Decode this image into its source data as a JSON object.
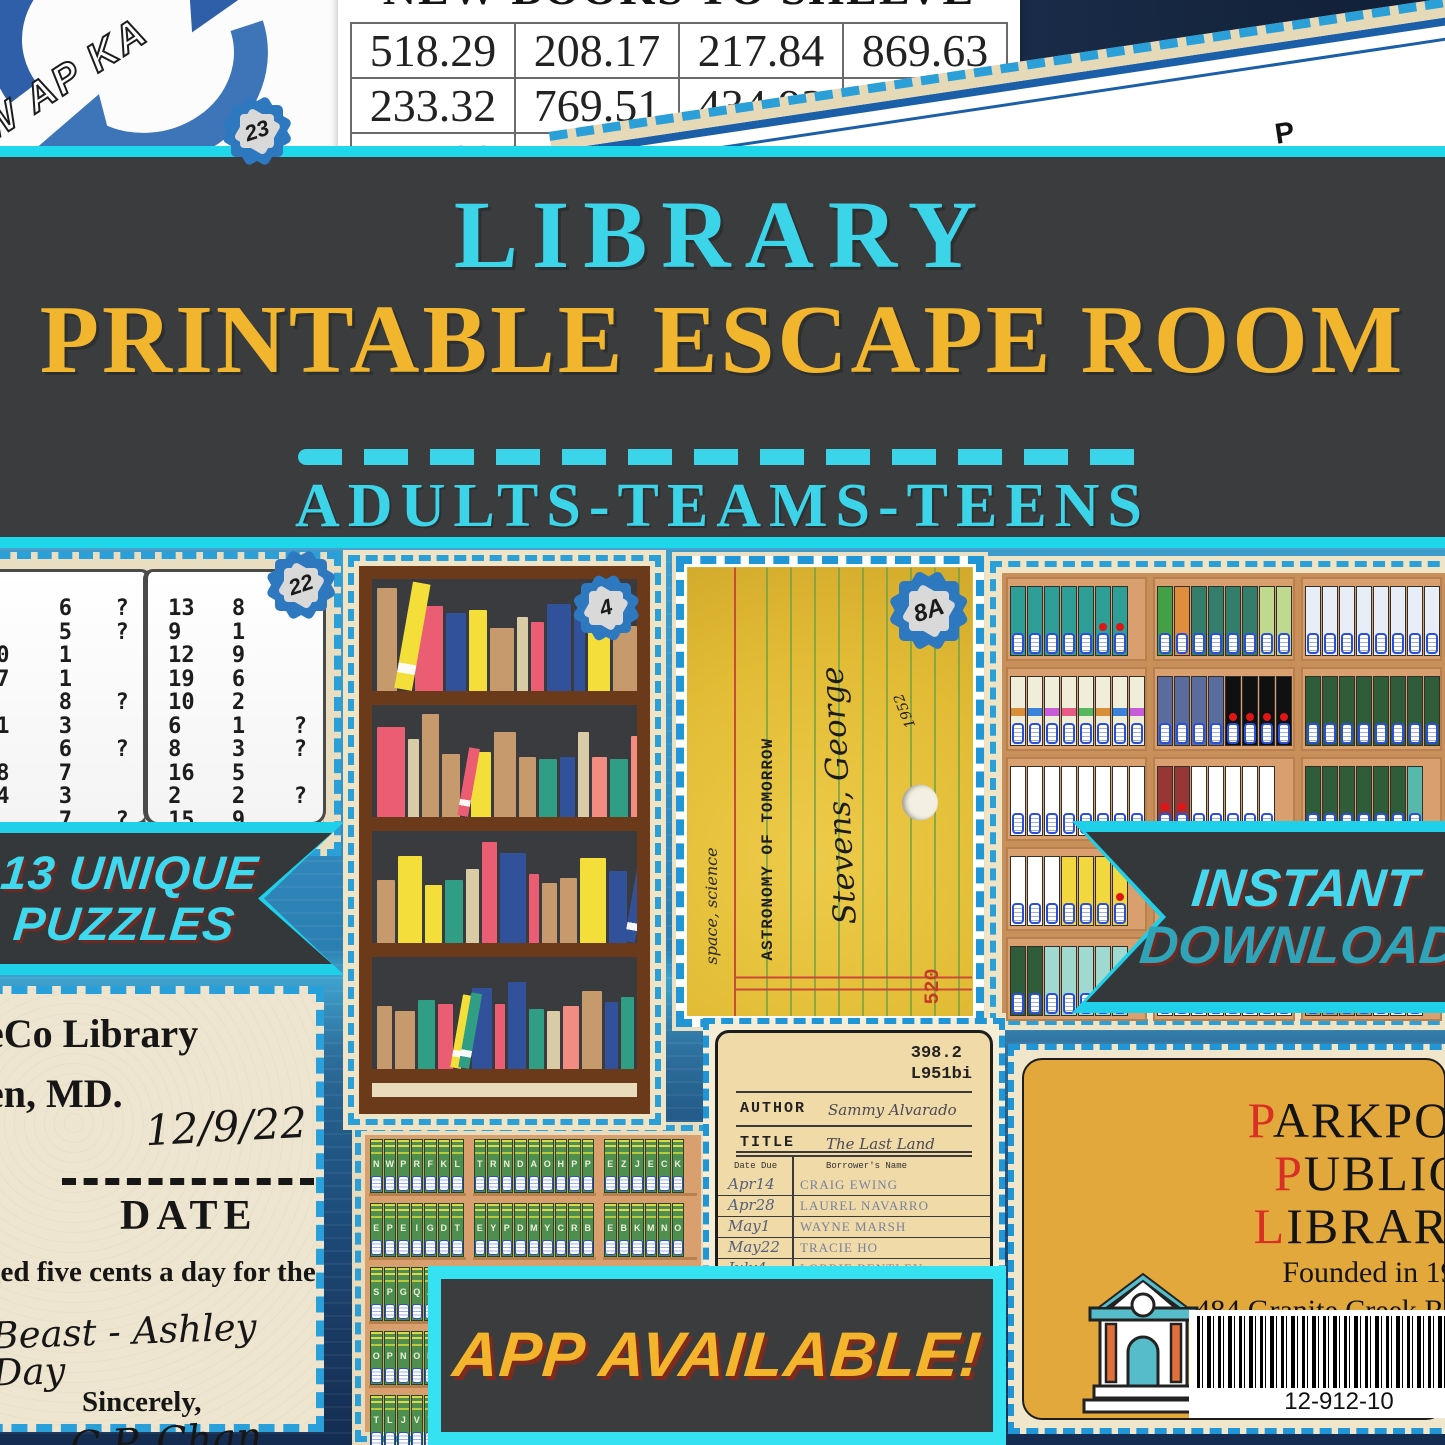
{
  "colors": {
    "accent_cyan": "#2BD9EE",
    "title_cyan": "#3CD4E9",
    "title_yellow": "#F1B62E",
    "dark_bg": "#3B3C3E",
    "blue_bg": "#3E9CCB",
    "dash_blue": "#2A9FD8",
    "ribbon_shadow": "#6E2A22",
    "gold_card": "#E2A83B",
    "red_initial": "#D93025"
  },
  "top": {
    "spinner_card": {
      "letters": "AW AP KA",
      "badge": "23"
    },
    "shelve_table": {
      "title": "NEW BOOKS TO SHELVE",
      "rows": [
        [
          "518.29",
          "208.17",
          "217.84",
          "869.63"
        ],
        [
          "233.32",
          "769.51",
          "434.93",
          "29"
        ],
        [
          "747.93",
          "113.38",
          "423.18",
          "23"
        ]
      ]
    },
    "chapter_card": {
      "items": [
        {
          "letter": "G",
          "word": "Page"
        },
        {
          "letter": "Y",
          "word": "Chapter"
        },
        {
          "letter": "P",
          "word": "Chapter"
        }
      ]
    }
  },
  "banner": {
    "title_line1": "LIBRARY",
    "title_line2": "PRINTABLE ESCAPE ROOM",
    "audience": "ADULTS-TEAMS-TEENS"
  },
  "ribbons": {
    "puzzles": [
      "13 UNIQUE",
      "PUZZLES"
    ],
    "instant": [
      "INSTANT",
      "DOWNLOAD"
    ],
    "app": "APP AVAILABLE!"
  },
  "book_puzzle": {
    "badge": "22",
    "left": [
      [
        "3",
        "6",
        "?"
      ],
      [
        "1",
        "5",
        "?"
      ],
      [
        "20",
        "1",
        ""
      ],
      [
        "17",
        "1",
        ""
      ],
      [
        "7",
        "8",
        "?"
      ],
      [
        "11",
        "3",
        ""
      ],
      [
        "4",
        "6",
        "?"
      ],
      [
        "18",
        "7",
        ""
      ],
      [
        "14",
        "3",
        ""
      ],
      [
        "5",
        "7",
        "?"
      ]
    ],
    "right": [
      [
        "13",
        "8",
        ""
      ],
      [
        "9",
        "1",
        ""
      ],
      [
        "12",
        "9",
        ""
      ],
      [
        "19",
        "6",
        ""
      ],
      [
        "10",
        "2",
        ""
      ],
      [
        "6",
        "1",
        "?"
      ],
      [
        "8",
        "3",
        "?"
      ],
      [
        "16",
        "5",
        ""
      ],
      [
        "2",
        "2",
        "?"
      ],
      [
        "15",
        "9",
        ""
      ]
    ]
  },
  "shelf_puzzle": {
    "badge": "4",
    "shelves": [
      [
        [
          "#C69A6D",
          20,
          92,
          1
        ],
        [
          "#F4DE3A",
          18,
          96,
          4
        ],
        [
          "#EA5D72",
          28,
          76,
          1
        ],
        [
          "#31519B",
          20,
          70,
          2
        ],
        [
          "#F4DE3A",
          18,
          72,
          2
        ],
        [
          "#C69A6D",
          24,
          56,
          1
        ],
        [
          "#D8CBA5",
          11,
          66,
          0
        ],
        [
          "#EA5D72",
          13,
          62,
          1
        ],
        [
          "#31519B",
          24,
          78,
          1
        ],
        [
          "#31519B",
          11,
          72,
          3
        ],
        [
          "#F4DE3A",
          22,
          60,
          1
        ],
        [
          "#C69A6D",
          24,
          58,
          1
        ],
        [
          "#F28B82",
          16,
          54,
          2
        ],
        [
          "#C69A6D",
          13,
          56,
          1
        ],
        [
          "#2F9E85",
          26,
          76,
          3
        ]
      ],
      [
        [
          "#EA5D72",
          28,
          80,
          3
        ],
        [
          "#D8CBA5",
          11,
          70,
          0
        ],
        [
          "#C69A6D",
          17,
          92,
          3
        ],
        [
          "#C69A6D",
          18,
          56,
          1
        ],
        [
          "#EA5D72",
          11,
          62,
          4
        ],
        [
          "#F4DE3A",
          20,
          58,
          2
        ],
        [
          "#C69A6D",
          22,
          76,
          2
        ],
        [
          "#C69A6D",
          17,
          54,
          1
        ],
        [
          "#2F9E85",
          18,
          52,
          1
        ],
        [
          "#31519B",
          15,
          54,
          3
        ],
        [
          "#D8CBA5",
          11,
          76,
          0
        ],
        [
          "#F28B82",
          15,
          54,
          1
        ],
        [
          "#2F9E85",
          18,
          52,
          1
        ],
        [
          "#F28B82",
          24,
          72,
          3
        ]
      ],
      [
        [
          "#C69A6D",
          18,
          56,
          1
        ],
        [
          "#F4DE3A",
          24,
          78,
          3
        ],
        [
          "#F4DE3A",
          17,
          52,
          2
        ],
        [
          "#2F9E85",
          18,
          56,
          2
        ],
        [
          "#D8CBA5",
          13,
          66,
          0
        ],
        [
          "#EA5D72",
          15,
          90,
          3
        ],
        [
          "#31519B",
          26,
          80,
          3
        ],
        [
          "#EA5D72",
          10,
          62,
          2
        ],
        [
          "#C69A6D",
          15,
          54,
          1
        ],
        [
          "#C69A6D",
          17,
          58,
          1
        ],
        [
          "#F4DE3A",
          26,
          76,
          3
        ],
        [
          "#31519B",
          18,
          64,
          3
        ],
        [
          "#31519B",
          11,
          72,
          4
        ]
      ],
      [
        [
          "#C69A6D",
          15,
          56,
          1
        ],
        [
          "#C69A6D",
          20,
          52,
          1
        ],
        [
          "#2F9E85",
          17,
          62,
          2
        ],
        [
          "#EA5D72",
          15,
          58,
          1
        ],
        [
          "#F4DE3A",
          11,
          66,
          4
        ],
        [
          "#2F9E85",
          11,
          68,
          4
        ],
        [
          "#31519B",
          20,
          72,
          3
        ],
        [
          "#EA5D72",
          10,
          58,
          2
        ],
        [
          "#31519B",
          18,
          78,
          3
        ],
        [
          "#2F9E85",
          15,
          54,
          1
        ],
        [
          "#D8CBA5",
          13,
          52,
          0
        ],
        [
          "#F28B82",
          16,
          56,
          1
        ],
        [
          "#C69A6D",
          20,
          70,
          2
        ],
        [
          "#31519B",
          13,
          60,
          3
        ],
        [
          "#2F9E85",
          13,
          64,
          2
        ],
        [
          "#C69A6D",
          15,
          88,
          3
        ]
      ]
    ]
  },
  "pocket_card": {
    "badge": "8A",
    "subject": "space, science",
    "title": "ASTRONOMY OF TOMORROW",
    "call_number": "520",
    "borrower": "Stevens, George",
    "year": "1952"
  },
  "binder_card": {
    "grid": [
      [
        [
          [
            "#2E9E96",
            7,
            2,
            ""
          ]
        ],
        [
          [
            "#43A047",
            1,
            0,
            ""
          ],
          [
            "#E08E3C",
            1,
            0,
            ""
          ],
          [
            "#337E6A",
            4,
            0,
            "y"
          ],
          [
            "#BFD98F",
            3,
            0,
            ""
          ]
        ],
        [
          [
            "#E8EEF8",
            9,
            0,
            "w"
          ],
          [
            "#EBD9EA",
            3,
            0,
            "l"
          ]
        ]
      ],
      [
        [
          [
            "#F0EDD8",
            8,
            0,
            "r"
          ]
        ],
        [
          [
            "#5A6B9E",
            4,
            0,
            ""
          ],
          [
            "#101010",
            4,
            4,
            "y"
          ]
        ],
        [
          [
            "#2F5D3A",
            8,
            0,
            "y"
          ]
        ]
      ],
      [
        [
          [
            "#FFFFFF",
            8,
            0,
            "t"
          ]
        ],
        [
          [
            "#973636",
            2,
            2,
            ""
          ],
          [
            "#FFFFFF",
            5,
            0,
            "t"
          ]
        ],
        [
          [
            "#2F5D3A",
            6,
            0,
            "y"
          ],
          [
            "#57B8AC",
            1,
            0,
            ""
          ]
        ]
      ],
      [
        [
          [
            "#FFFFFF",
            3,
            0,
            "w"
          ],
          [
            "#F2D73E",
            4,
            1,
            ""
          ]
        ],
        [],
        []
      ],
      [
        [
          [
            "#2F5D3A",
            2,
            0,
            ""
          ],
          [
            "#9FD9CF",
            5,
            0,
            ""
          ]
        ],
        [
          [
            "#FFFFFF",
            10,
            0,
            ""
          ]
        ],
        [
          [
            "#C69A6D",
            4,
            0,
            ""
          ],
          [
            "#F0EDD8",
            3,
            0,
            ""
          ]
        ]
      ]
    ]
  },
  "letter": {
    "line1": "eCo Library",
    "line2": "en, MD.",
    "date_hand": "12/9/22",
    "date_label": "DATE",
    "body": "ged five cents a day for the",
    "hand_line": "Beast - Ashley Day",
    "closing": "Sincerely,",
    "signature": "C.P. Chan",
    "role": "Librarian"
  },
  "encyclopedia": {
    "cols": [
      [
        "N W P R F K L",
        "E P E I G D T",
        "S P G Q A",
        "O P N O K",
        "T L J V T"
      ],
      [
        "T R N D A O H P P",
        "E Y P D M Y C R B",
        "- - - - - - - - -",
        "- - - - - - - - -",
        "- - - - - - - - -"
      ],
      [
        "E Z J E C K",
        "E B K M N O",
        "- - - - - -",
        "- - - - - -",
        "- - - - - -"
      ]
    ]
  },
  "checkout": {
    "call1": "398.2",
    "call2": "L951bi",
    "author_label": "AUTHOR",
    "author": "Sammy Alvarado",
    "title_label": "TITLE",
    "title": "The Last Land",
    "col_date": "Date Due",
    "col_name": "Borrower's Name",
    "rows": [
      [
        "Apr14",
        "CRAIG EWING"
      ],
      [
        "Apr28",
        "LAUREL NAVARRO"
      ],
      [
        "May1",
        "WAYNE MARSH"
      ],
      [
        "May22",
        "TRACIE HO"
      ],
      [
        "July4",
        "LORRIE BENTLEY"
      ],
      [
        "Aug4",
        "NESSIE HASTINGS"
      ]
    ]
  },
  "parkpool": {
    "l1f": "P",
    "l1r": "ARKPOO",
    "l2f": "P",
    "l2r": "UBLIC",
    "l3f": "L",
    "l3r": "IBRARY",
    "founded": "Founded in 19",
    "address": "484 Granite Creek Road, Ma",
    "barcode": "12-912-10"
  }
}
